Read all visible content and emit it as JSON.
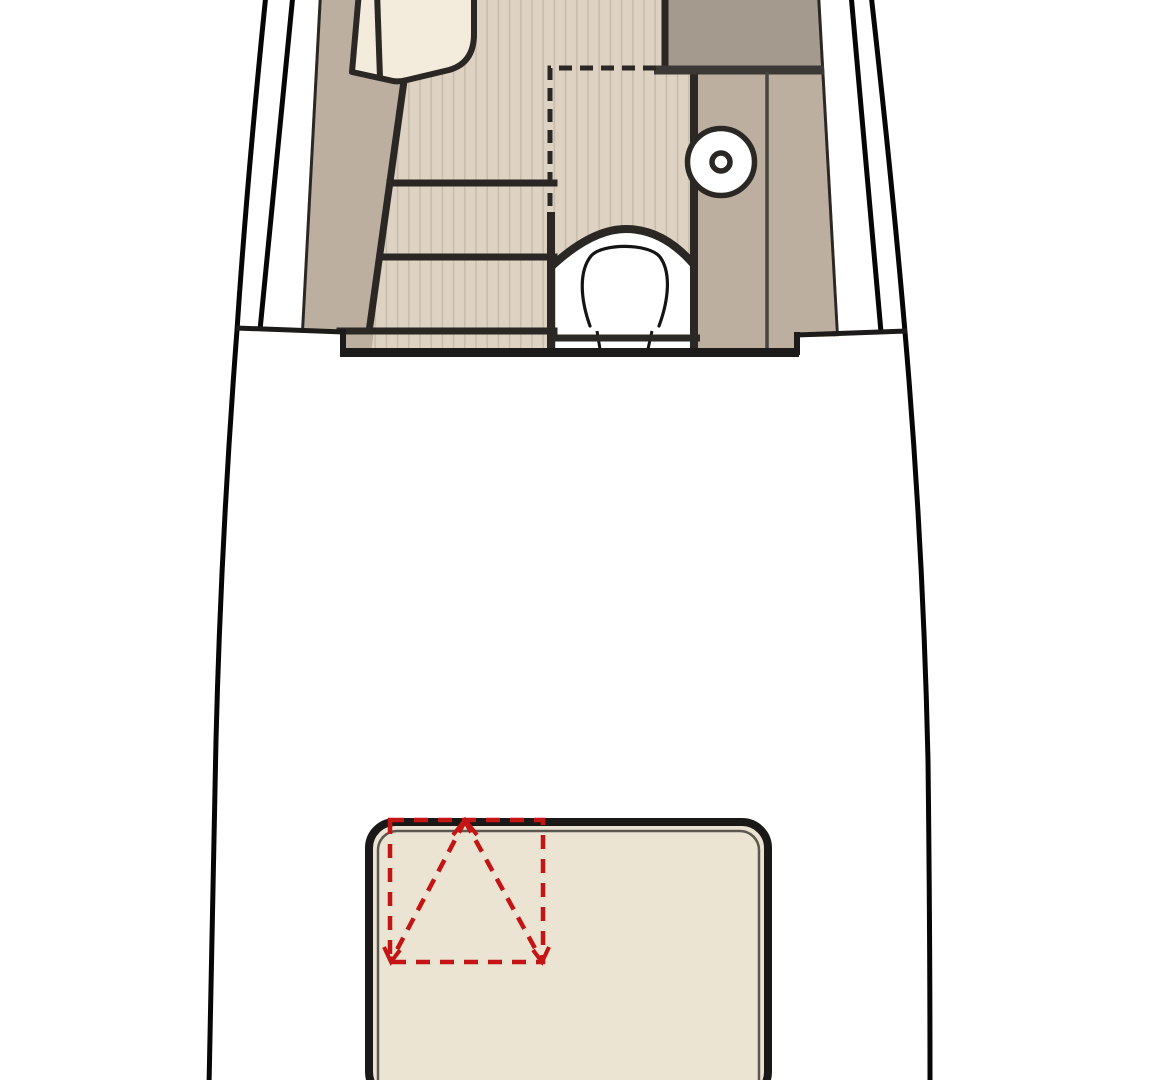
{
  "plan": {
    "type": "boat-floorplan-section",
    "symbols": {
      "hatch_opening": "red-dashed-square-with-triangle-arrows",
      "sink": "circle-with-center-drain",
      "toilet": "horseshoe-bowl-in-arched-alcove",
      "steps": "three-tread-companionway"
    }
  },
  "colors": {
    "background": "#ffffff",
    "hull_line": "#060606",
    "wall_line": "#2a2724",
    "deck_line": "#1d1b19",
    "wood_floor": "#ded3c3",
    "wood_stripe": "#c8bcab",
    "taupe": "#bcafa0",
    "dark_counter": "#a59a8e",
    "under_counter_bar": "#3b3835",
    "thin_line": "#48443e",
    "seat_cream": "#f3ecdc",
    "fixture_white": "#ffffff",
    "toilet_line": "#141414",
    "sunpad": "#ece4d2",
    "sunpad_border": "#1a1918",
    "sunpad_inner": "#5b5751",
    "hatch_red": "#c41414"
  }
}
